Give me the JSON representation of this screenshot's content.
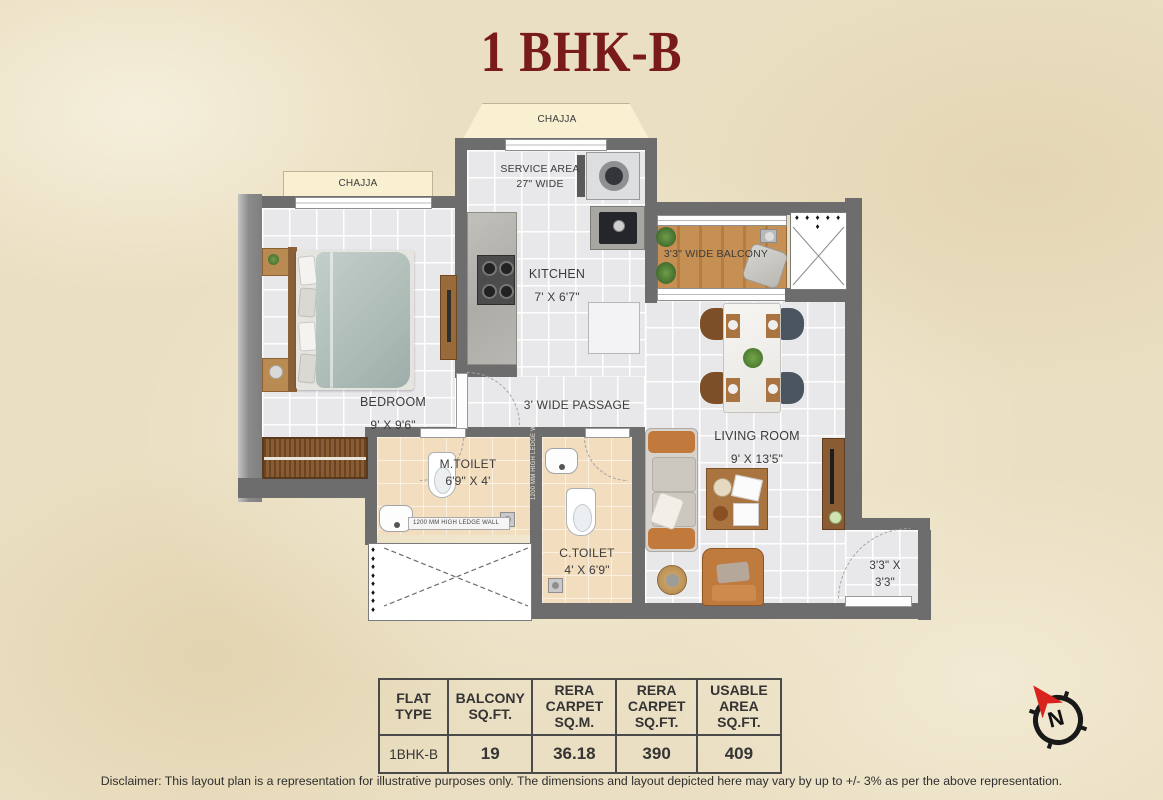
{
  "title": "1 BHK-B",
  "rooms": {
    "chajja_top": "CHAJJA",
    "chajja_left": "CHAJJA",
    "service_name": "SERVICE AREA",
    "service_dim": "27\" WIDE",
    "kitchen_name": "KITCHEN",
    "kitchen_dim": "7' X 6'7\"",
    "bedroom_name": "BEDROOM",
    "bedroom_dim": "9' X 9'6\"",
    "balcony_label": "3'3\" WIDE BALCONY",
    "passage_label": "3' WIDE PASSAGE",
    "living_name": "LIVING ROOM",
    "living_dim": "9' X 13'5\"",
    "mtoilet_name": "M.TOILET",
    "mtoilet_dim": "6'9\" X 4'",
    "ctoilet_name": "C.TOILET",
    "ctoilet_dim": "4' X 6'9\"",
    "entry_dim": "3'3\" X\n3'3\"",
    "ledge_wall": "1200 MM HIGH LEDGE WALL"
  },
  "decor": {
    "dots_row": "♦ ♦ ♦ ♦ ♦ ♦",
    "dots_col": "♦\n♦\n♦\n♦\n♦\n♦\n♦\n♦"
  },
  "table": {
    "headers": [
      "FLAT\nTYPE",
      "BALCONY\nSQ.FT.",
      "RERA\nCARPET\nSQ.M.",
      "RERA\nCARPET\nSQ.FT.",
      "USABLE\nAREA\nSQ.FT."
    ],
    "row": [
      "1BHK-B",
      "19",
      "36.18",
      "390",
      "409"
    ]
  },
  "compass": {
    "label": "N"
  },
  "disclaimer": "Disclaimer: This layout plan is a representation for illustrative purposes only. The dimensions and layout depicted here may vary by up to +/- 3% as per the above representation.",
  "colors": {
    "accent_maroon": "#7a1b1b",
    "wall_gray": "#6d6d6d",
    "chajja_cream": "#f8f0d0",
    "balcony_wood": "#c68f53",
    "toilet_beige": "#f3ddbf"
  }
}
